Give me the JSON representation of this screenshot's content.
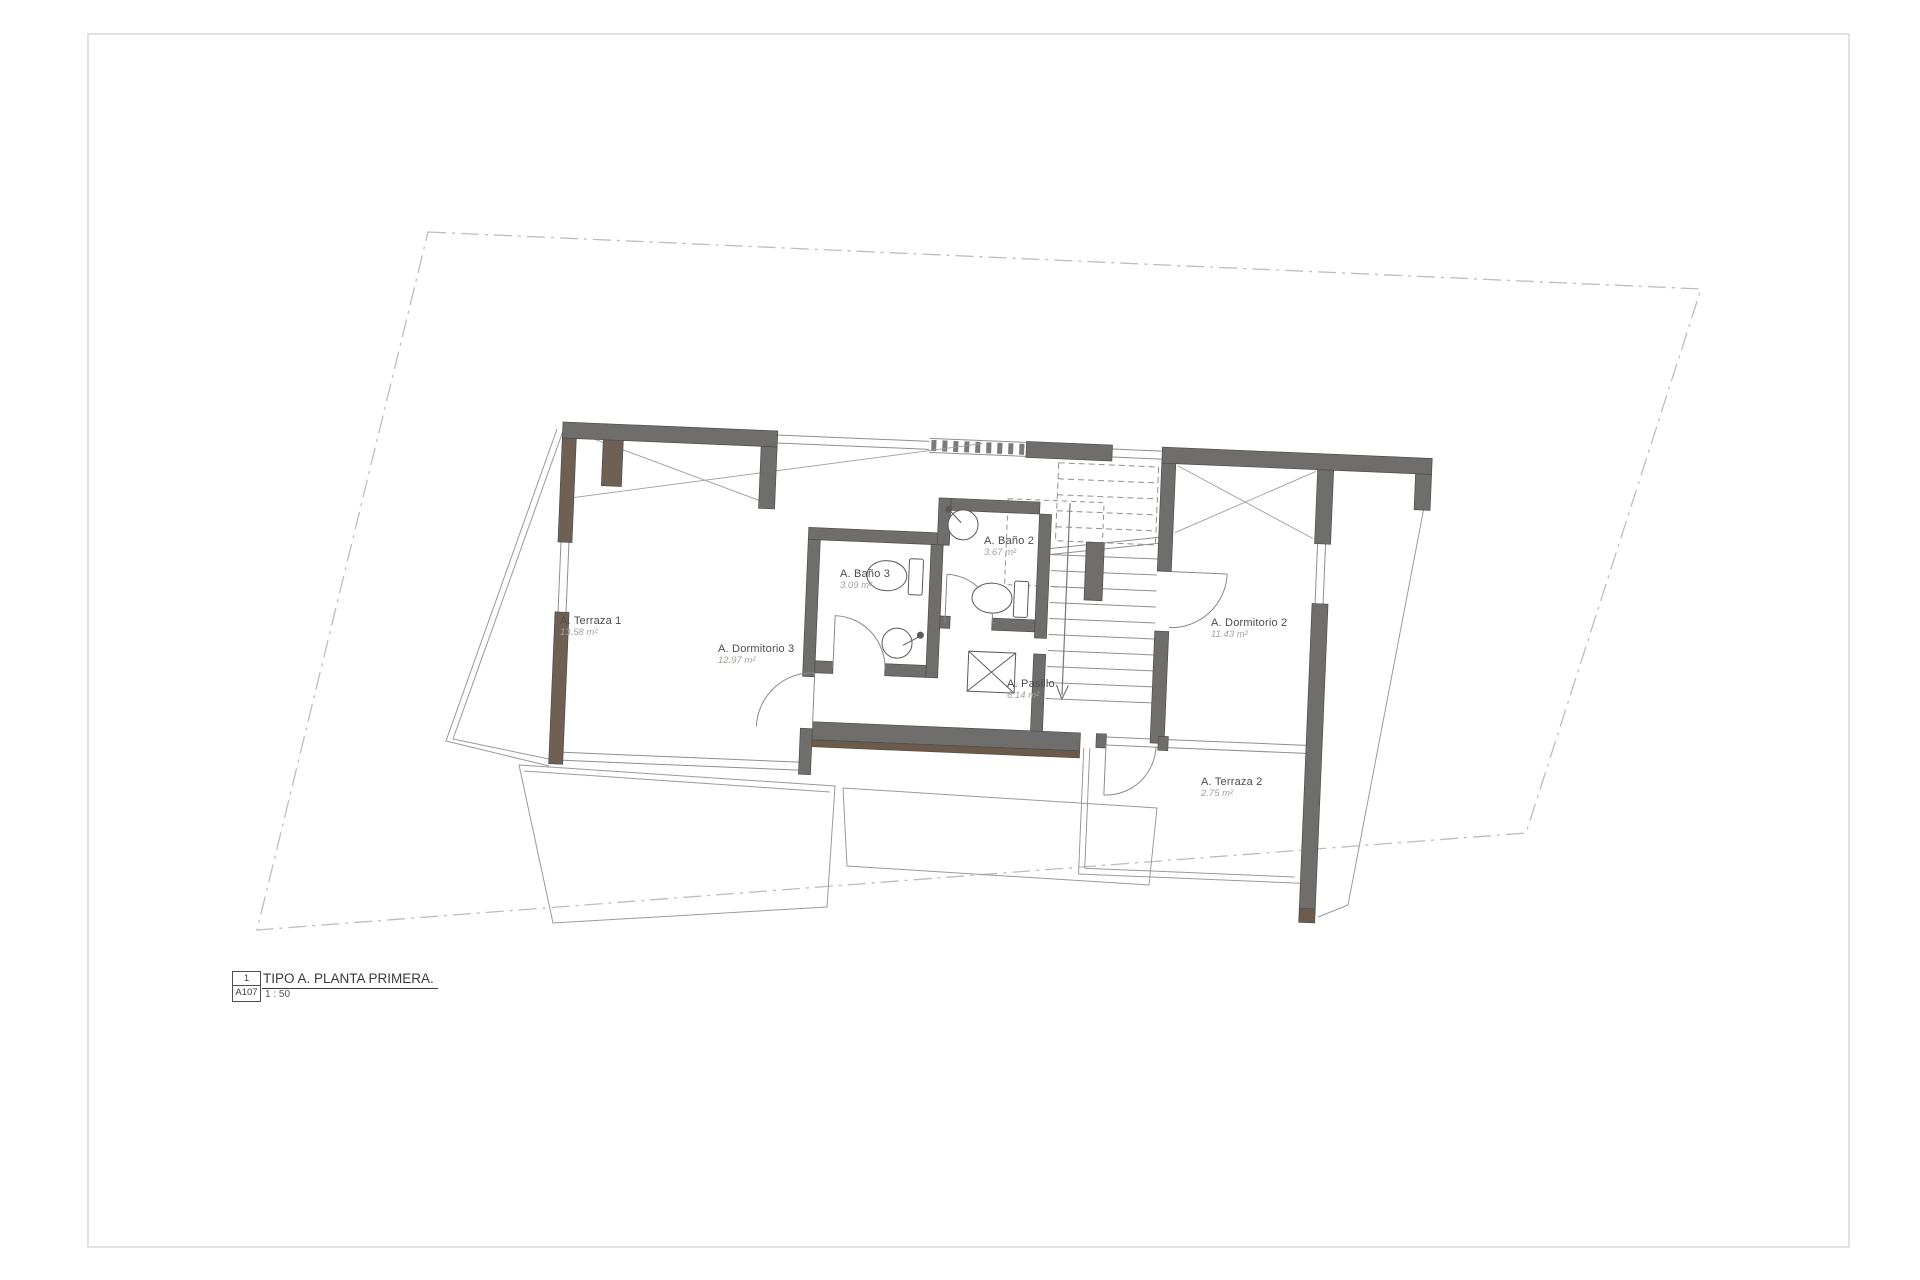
{
  "drawing": {
    "type": "architectural-floor-plan",
    "rooms": [
      {
        "name": "A. Terraza 1",
        "area": "13.58 m²"
      },
      {
        "name": "A. Dormitorio 3",
        "area": "12.97 m²"
      },
      {
        "name": "A. Baño 3",
        "area": "3.09 m²"
      },
      {
        "name": "A. Baño 2",
        "area": "3.67 m²"
      },
      {
        "name": "A. Pasillo",
        "area": "6.14 m²"
      },
      {
        "name": "A. Dormitorio 2",
        "area": "11.43 m²"
      },
      {
        "name": "A. Terraza 2",
        "area": "2.75 m²"
      }
    ],
    "title_block": {
      "detail_number": "1",
      "sheet_ref": "A107",
      "title": "TIPO A. PLANTA PRIMERA.",
      "scale": "1 : 50"
    },
    "colors": {
      "wall_gray": "#6f6e6c",
      "wall_wood": "#6e6154",
      "wood_accent": "#6c5a4a",
      "thin_line": "#8f8f8f",
      "boundary_line": "#bdbdbd",
      "fixture_line": "#5a5a5a",
      "label_text": "#4b4b4b",
      "area_text": "#a5a19b"
    }
  }
}
